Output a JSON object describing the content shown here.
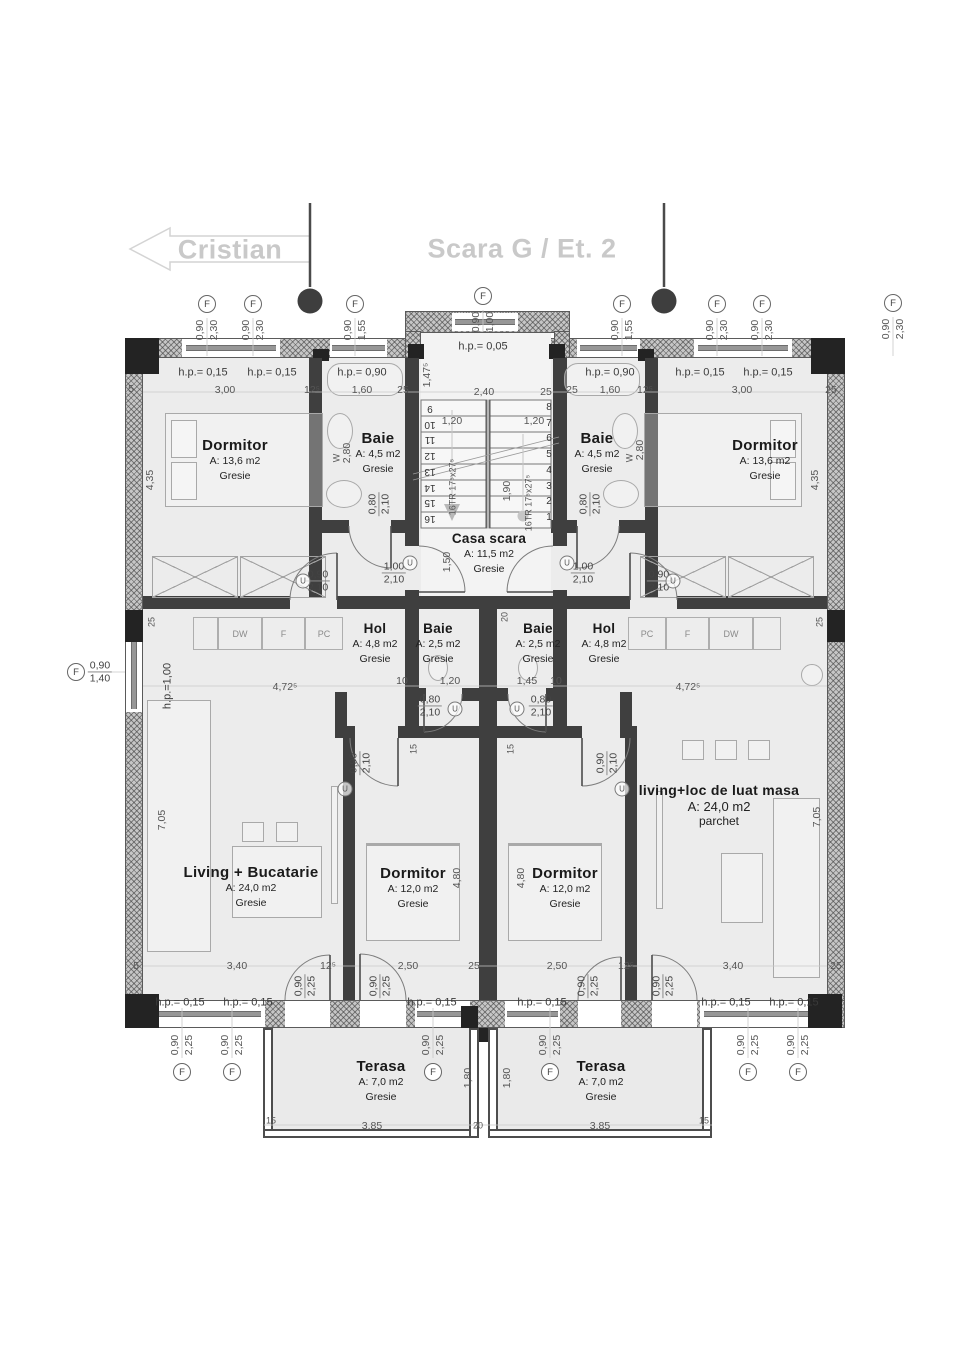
{
  "title": {
    "neighbor": "Cristian",
    "main": "Scara G / Et. 2"
  },
  "sym": {
    "u": "U",
    "f": "F"
  },
  "rooms": [
    {
      "name": "Dormitor",
      "area": "A: 13,6 m2",
      "floor": "Gresie"
    },
    {
      "name": "Baie",
      "area": "A: 4,5 m2",
      "floor": "Gresie"
    },
    {
      "name": "Casa scara",
      "area": "A: 11,5 m2",
      "floor": "Gresie"
    },
    {
      "name": "Baie",
      "area": "A: 4,5 m2",
      "floor": "Gresie"
    },
    {
      "name": "Dormitor",
      "area": "A: 13,6 m2",
      "floor": "Gresie"
    },
    {
      "name": "Hol",
      "area": "A: 4,8 m2",
      "floor": "Gresie"
    },
    {
      "name": "Baie",
      "area": "A: 2,5 m2",
      "floor": "Gresie"
    },
    {
      "name": "Baie",
      "area": "A: 2,5 m2",
      "floor": "Gresie"
    },
    {
      "name": "Hol",
      "area": "A: 4,8 m2",
      "floor": "Gresie"
    },
    {
      "name": "Living + Bucatarie",
      "area": "A: 24,0 m2",
      "floor": "Gresie"
    },
    {
      "name": "Dormitor",
      "area": "A: 12,0 m2",
      "floor": "Gresie"
    },
    {
      "name": "Dormitor",
      "area": "A: 12,0 m2",
      "floor": "Gresie"
    },
    {
      "name": "living+loc de luat masa",
      "area": "A: 24,0 m2",
      "floor": "parchet"
    },
    {
      "name": "Terasa",
      "area": "A: 7,0 m2",
      "floor": "Gresie"
    },
    {
      "name": "Terasa",
      "area": "A: 7,0 m2",
      "floor": "Gresie"
    }
  ],
  "kitchen": {
    "left": [
      "DW",
      "F",
      "PC"
    ],
    "right": [
      "PC",
      "F",
      "DW"
    ]
  },
  "stairs": {
    "left": [
      "9",
      "10",
      "11",
      "12",
      "13",
      "14",
      "15",
      "16"
    ],
    "right": [
      "8",
      "7",
      "6",
      "5",
      "4",
      "3",
      "2",
      "1"
    ],
    "flight_label": "16TR 17⁵x27⁵"
  },
  "annotations": [
    {
      "t": "h.p.= 0,15",
      "x": 203,
      "y": 373,
      "c": "hp"
    },
    {
      "t": "h.p.= 0,15",
      "x": 272,
      "y": 373,
      "c": "hp"
    },
    {
      "t": "h.p.= 0,90",
      "x": 362,
      "y": 373,
      "c": "hp"
    },
    {
      "t": "h.p.= 0,05",
      "x": 483,
      "y": 347,
      "c": "hp"
    },
    {
      "t": "h.p.= 0,90",
      "x": 610,
      "y": 373,
      "c": "hp"
    },
    {
      "t": "h.p.= 0,15",
      "x": 700,
      "y": 373,
      "c": "hp"
    },
    {
      "t": "h.p.= 0,15",
      "x": 768,
      "y": 373,
      "c": "hp"
    },
    {
      "t": "5",
      "x": 131,
      "y": 389
    },
    {
      "t": "3,00",
      "x": 225,
      "y": 390
    },
    {
      "t": "12⁵",
      "x": 312,
      "y": 390
    },
    {
      "t": "1,60",
      "x": 362,
      "y": 390
    },
    {
      "t": "25",
      "x": 403,
      "y": 390
    },
    {
      "t": "2,40",
      "x": 484,
      "y": 392
    },
    {
      "t": "25",
      "x": 546,
      "y": 392
    },
    {
      "t": "25",
      "x": 572,
      "y": 390
    },
    {
      "t": "1,60",
      "x": 610,
      "y": 390
    },
    {
      "t": "12⁵",
      "x": 645,
      "y": 390
    },
    {
      "t": "3,00",
      "x": 742,
      "y": 390
    },
    {
      "t": "25",
      "x": 831,
      "y": 390
    },
    {
      "t": "1,20",
      "x": 452,
      "y": 421
    },
    {
      "t": "1,20",
      "x": 534,
      "y": 421
    },
    {
      "t": "1,47⁵",
      "x": 427,
      "y": 375,
      "r": -90
    },
    {
      "t": "1,50",
      "x": 447,
      "y": 562,
      "r": -90
    },
    {
      "t": "1,90",
      "x": 507,
      "y": 491,
      "r": -90
    },
    {
      "t": "16TR 17⁵x27⁵",
      "x": 453,
      "y": 487,
      "r": -90,
      "c": "s9"
    },
    {
      "t": "16TR 17⁵x27⁵",
      "x": 529,
      "y": 503,
      "r": -90,
      "c": "s9"
    },
    {
      "t": "4,35",
      "x": 150,
      "y": 480,
      "r": -90
    },
    {
      "t": "2,80",
      "x": 347,
      "y": 453,
      "r": -90
    },
    {
      "t": "2,80",
      "x": 640,
      "y": 450,
      "r": -90
    },
    {
      "t": "4,35",
      "x": 815,
      "y": 480,
      "r": -90
    },
    {
      "t": "W",
      "x": 337,
      "y": 458,
      "r": -90,
      "c": "s9"
    },
    {
      "t": "W",
      "x": 630,
      "y": 458,
      "r": -90,
      "c": "s9"
    },
    {
      "t": "25",
      "x": 152,
      "y": 622,
      "r": -90,
      "c": "s9"
    },
    {
      "t": "25",
      "x": 820,
      "y": 622,
      "r": -90,
      "c": "s9"
    },
    {
      "t": "20",
      "x": 505,
      "y": 617,
      "r": -90,
      "c": "s9"
    },
    {
      "t": "h.p.=1,00",
      "x": 168,
      "y": 686,
      "r": -90,
      "c": "hp"
    },
    {
      "t": "10",
      "x": 402,
      "y": 681
    },
    {
      "t": "1,20",
      "x": 450,
      "y": 681
    },
    {
      "t": "1,45",
      "x": 527,
      "y": 681
    },
    {
      "t": "10",
      "x": 556,
      "y": 681
    },
    {
      "t": "4,72⁵",
      "x": 285,
      "y": 687
    },
    {
      "t": "4,72⁵",
      "x": 688,
      "y": 687
    },
    {
      "t": "15",
      "x": 414,
      "y": 749,
      "r": -90,
      "c": "s9"
    },
    {
      "t": "15",
      "x": 511,
      "y": 749,
      "r": -90,
      "c": "s9"
    },
    {
      "t": "7,05",
      "x": 162,
      "y": 820,
      "r": -90
    },
    {
      "t": "7,05",
      "x": 817,
      "y": 817,
      "r": -90
    },
    {
      "t": "4,80",
      "x": 457,
      "y": 878,
      "r": -90
    },
    {
      "t": "4,80",
      "x": 521,
      "y": 878,
      "r": -90
    },
    {
      "t": "5",
      "x": 136,
      "y": 966
    },
    {
      "t": "3,40",
      "x": 237,
      "y": 966
    },
    {
      "t": "12⁵",
      "x": 328,
      "y": 966
    },
    {
      "t": "2,50",
      "x": 408,
      "y": 966
    },
    {
      "t": "25",
      "x": 474,
      "y": 966
    },
    {
      "t": "2,50",
      "x": 557,
      "y": 966
    },
    {
      "t": "12⁵",
      "x": 626,
      "y": 966
    },
    {
      "t": "3,40",
      "x": 733,
      "y": 966
    },
    {
      "t": "25",
      "x": 836,
      "y": 966
    },
    {
      "t": "h.p.= 0,15",
      "x": 180,
      "y": 1003,
      "c": "hp"
    },
    {
      "t": "h.p.= 0,15",
      "x": 248,
      "y": 1003,
      "c": "hp"
    },
    {
      "t": "h.p.= 0,15",
      "x": 432,
      "y": 1003,
      "c": "hp"
    },
    {
      "t": "h.p.= 0,15",
      "x": 542,
      "y": 1003,
      "c": "hp"
    },
    {
      "t": "h.p.= 0,15",
      "x": 726,
      "y": 1003,
      "c": "hp"
    },
    {
      "t": "h.p.= 0,15",
      "x": 794,
      "y": 1003,
      "c": "hp"
    },
    {
      "t": "1,80",
      "x": 468,
      "y": 1078,
      "r": -90
    },
    {
      "t": "1,80",
      "x": 507,
      "y": 1078,
      "r": -90
    },
    {
      "t": "15",
      "x": 271,
      "y": 1121,
      "c": "s9"
    },
    {
      "t": "3,85",
      "x": 372,
      "y": 1126
    },
    {
      "t": "20",
      "x": 478,
      "y": 1126,
      "c": "s9"
    },
    {
      "t": "3,85",
      "x": 600,
      "y": 1126
    },
    {
      "t": "15",
      "x": 704,
      "y": 1121,
      "c": "s9"
    }
  ],
  "fracs": [
    {
      "a": "0,90",
      "b": "2,10",
      "x": 318,
      "y": 581
    },
    {
      "a": "1,00",
      "b": "2,10",
      "x": 394,
      "y": 573
    },
    {
      "a": "1,00",
      "b": "2,10",
      "x": 583,
      "y": 573
    },
    {
      "a": "0,90",
      "b": "2,10",
      "x": 659,
      "y": 581
    },
    {
      "a": "0,80",
      "b": "2,10",
      "x": 430,
      "y": 706
    },
    {
      "a": "0,80",
      "b": "2,10",
      "x": 541,
      "y": 706
    },
    {
      "a": "0,80",
      "b": "2,10",
      "x": 379,
      "y": 504,
      "r": -90
    },
    {
      "a": "0,80",
      "b": "2,10",
      "x": 590,
      "y": 504,
      "r": -90
    },
    {
      "a": "0,90",
      "b": "2,10",
      "x": 360,
      "y": 763,
      "r": -90
    },
    {
      "a": "0,90",
      "b": "2,10",
      "x": 607,
      "y": 763,
      "r": -90
    },
    {
      "a": "0,90",
      "b": "2,25",
      "x": 305,
      "y": 986,
      "r": -90
    },
    {
      "a": "0,90",
      "b": "2,25",
      "x": 380,
      "y": 986,
      "r": -90
    },
    {
      "a": "0,90",
      "b": "2,25",
      "x": 588,
      "y": 986,
      "r": -90
    },
    {
      "a": "0,90",
      "b": "2,25",
      "x": 663,
      "y": 986,
      "r": -90
    }
  ],
  "fmarkers": [
    {
      "x": 207,
      "y": 304,
      "a": "0,90",
      "b": "2,30",
      "o": "t"
    },
    {
      "x": 253,
      "y": 304,
      "a": "0,90",
      "b": "2,30",
      "o": "t"
    },
    {
      "x": 355,
      "y": 304,
      "a": "0,90",
      "b": "1,55",
      "o": "t"
    },
    {
      "x": 483,
      "y": 296,
      "a": "0,90",
      "b": "1,00",
      "o": "t"
    },
    {
      "x": 622,
      "y": 304,
      "a": "0,90",
      "b": "1,55",
      "o": "t"
    },
    {
      "x": 717,
      "y": 304,
      "a": "0,90",
      "b": "2,30",
      "o": "t"
    },
    {
      "x": 762,
      "y": 304,
      "a": "0,90",
      "b": "2,30",
      "o": "t"
    },
    {
      "x": 893,
      "y": 303,
      "a": "0,90",
      "b": "2,30",
      "o": "t"
    },
    {
      "x": 182,
      "y": 1072,
      "a": "0,90",
      "b": "2,25",
      "o": "b"
    },
    {
      "x": 232,
      "y": 1072,
      "a": "0,90",
      "b": "2,25",
      "o": "b"
    },
    {
      "x": 433,
      "y": 1072,
      "a": "0,90",
      "b": "2,25",
      "o": "b"
    },
    {
      "x": 550,
      "y": 1072,
      "a": "0,90",
      "b": "2,25",
      "o": "b"
    },
    {
      "x": 748,
      "y": 1072,
      "a": "0,90",
      "b": "2,25",
      "o": "b"
    },
    {
      "x": 798,
      "y": 1072,
      "a": "0,90",
      "b": "2,25",
      "o": "b"
    },
    {
      "x": 95,
      "y": 672,
      "a": "0,90",
      "b": "1,40",
      "o": "l"
    }
  ],
  "ucircles": [
    [
      303,
      581
    ],
    [
      673,
      581
    ],
    [
      410,
      563
    ],
    [
      567,
      563
    ],
    [
      455,
      709
    ],
    [
      517,
      709
    ],
    [
      345,
      789
    ],
    [
      622,
      789
    ]
  ]
}
